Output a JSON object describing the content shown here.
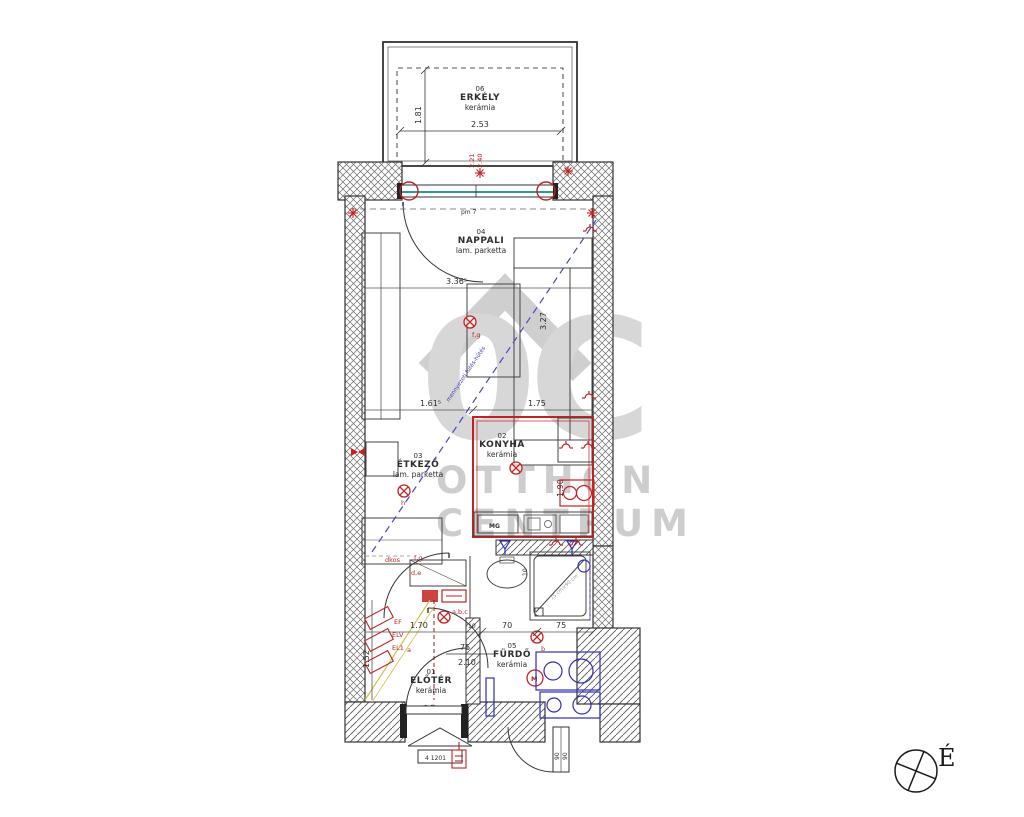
{
  "plan": {
    "rooms": [
      {
        "num": "06",
        "name": "ERKÉLY",
        "floor": "kerámia"
      },
      {
        "num": "04",
        "name": "NAPPALI",
        "floor": "lam. parketta"
      },
      {
        "num": "03",
        "name": "ÉTKEZŐ",
        "floor": "lam. parketta"
      },
      {
        "num": "02",
        "name": "KONYHA",
        "floor": "kerámia"
      },
      {
        "num": "05",
        "name": "FÜRDŐ",
        "floor": "kerámia"
      },
      {
        "num": "01",
        "name": "ELŐTÉR",
        "floor": "kerámia"
      }
    ],
    "dims": {
      "erkely_w": "2.53",
      "erkely_d": "1.81",
      "win_h1": "2.21",
      "win_h2": "2.40",
      "pm": "pm 7",
      "nappali_w": "3.36⁵",
      "nappali_d": "3.27",
      "etkezo_w": "1.61⁵",
      "konyha_w": "1.75",
      "konyha_d": "1.90",
      "bath1": "1.70",
      "bath2": "10",
      "bath3": "70",
      "bath4": "75",
      "hall1": "75",
      "hall2": "2.10",
      "left_d": "1.52",
      "shower_d": "10",
      "shower_size": "75 cm×90 cm",
      "door1": "90",
      "door2": "90",
      "entry1": "05",
      "entry2": "10"
    },
    "labels": {
      "mg": "MG",
      "m": "M",
      "door_sign": "4 1201",
      "north": "É",
      "l_fg1": "f,g",
      "l_h": "h",
      "l_fg2": "f,g",
      "l_de": "d,e",
      "l_dkos": "dkos",
      "l_abc": "a,b,c",
      "l_b": "b",
      "l_a": "a",
      "r_ef": "EF",
      "r_elv": "ELV",
      "r_el1": "EL1",
      "cut_note": "mennyezeti fűtés-hűtés"
    },
    "watermark": {
      "logo": "0C",
      "line1": "OTTHON",
      "line2": "CENTRUM"
    },
    "colors": {
      "red": "#c22222",
      "blue": "#2d2db8",
      "teal": "#2a9d8f",
      "watermark": "#d7d7d7"
    }
  }
}
